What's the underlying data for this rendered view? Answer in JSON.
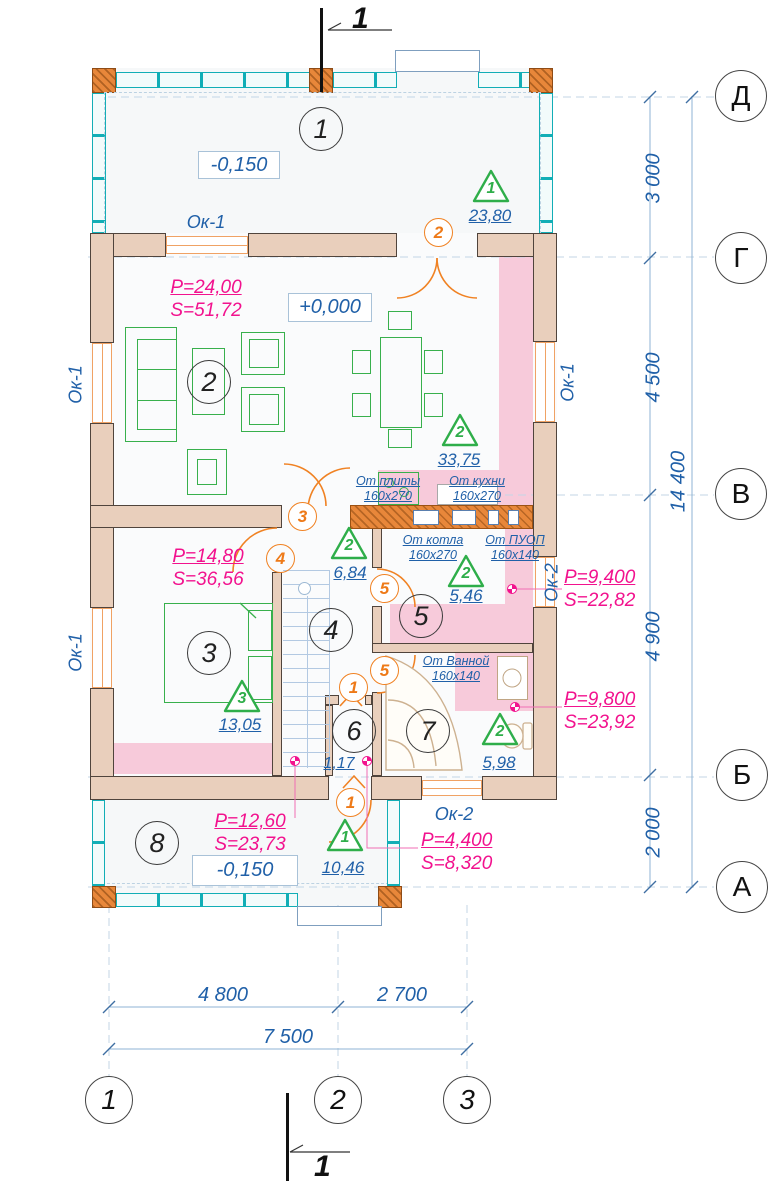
{
  "section_marks": {
    "top": "1",
    "bottom": "1"
  },
  "axis_rows": [
    "Д",
    "Г",
    "В",
    "Б",
    "А"
  ],
  "axis_cols": [
    "1",
    "2",
    "3"
  ],
  "dims": {
    "d1": "3 000",
    "d2": "4 500",
    "d3": "4 900",
    "d4": "2 000",
    "total_v": "14 400",
    "b1": "4 800",
    "b2": "2 700",
    "total_h": "7 500"
  },
  "levels": {
    "terrace": "-0,150",
    "ground": "+0,000",
    "porch": "-0,150"
  },
  "rooms": [
    "1",
    "2",
    "3",
    "4",
    "5",
    "6",
    "7",
    "8"
  ],
  "room_stats": {
    "living": {
      "p": "P=24,00",
      "s": "S=51,72"
    },
    "bedroom": {
      "p": "P=14,80",
      "s": "S=36,56"
    },
    "kitchen": {
      "p": "P=9,400",
      "s": "S=22,82"
    },
    "bathroom": {
      "p": "P=9,800",
      "s": "S=23,92"
    },
    "porch": {
      "p": "P=12,60",
      "s": "S=23,73"
    },
    "entry": {
      "p": "P=4,400",
      "s": "S=8,320"
    }
  },
  "triangles": [
    {
      "n": "1",
      "v": "23,80"
    },
    {
      "n": "2",
      "v": "33,75"
    },
    {
      "n": "2",
      "v": "6,84"
    },
    {
      "n": "2",
      "v": "5,46"
    },
    {
      "n": "3",
      "v": "13,05"
    },
    {
      "n": "2",
      "v": "5,98"
    },
    {
      "n": "1",
      "v": "10,46"
    }
  ],
  "doors": [
    "2",
    "3",
    "4",
    "5",
    "5",
    "1",
    "1"
  ],
  "windows": {
    "ok1": "Ок-1",
    "ok2": "Ок-2"
  },
  "vents": [
    {
      "name": "От плиты",
      "size": "160x270"
    },
    {
      "name": "От кухни",
      "size": "160x270"
    },
    {
      "name": "От котла",
      "size": "160x270"
    },
    {
      "name": "От ПУОП",
      "size": "160x140"
    },
    {
      "name": "От Ванной",
      "size": "160x140"
    }
  ],
  "stair_label": "1,17",
  "colors": {
    "wall": "#e9cfbc",
    "glazing": "#12aeb6",
    "warm_floor": "#f7cada",
    "accent_orange": "#f08223",
    "accent_green": "#2fae4a",
    "annotation_magenta": "#f2128e",
    "annotation_blue": "#2060a8"
  }
}
